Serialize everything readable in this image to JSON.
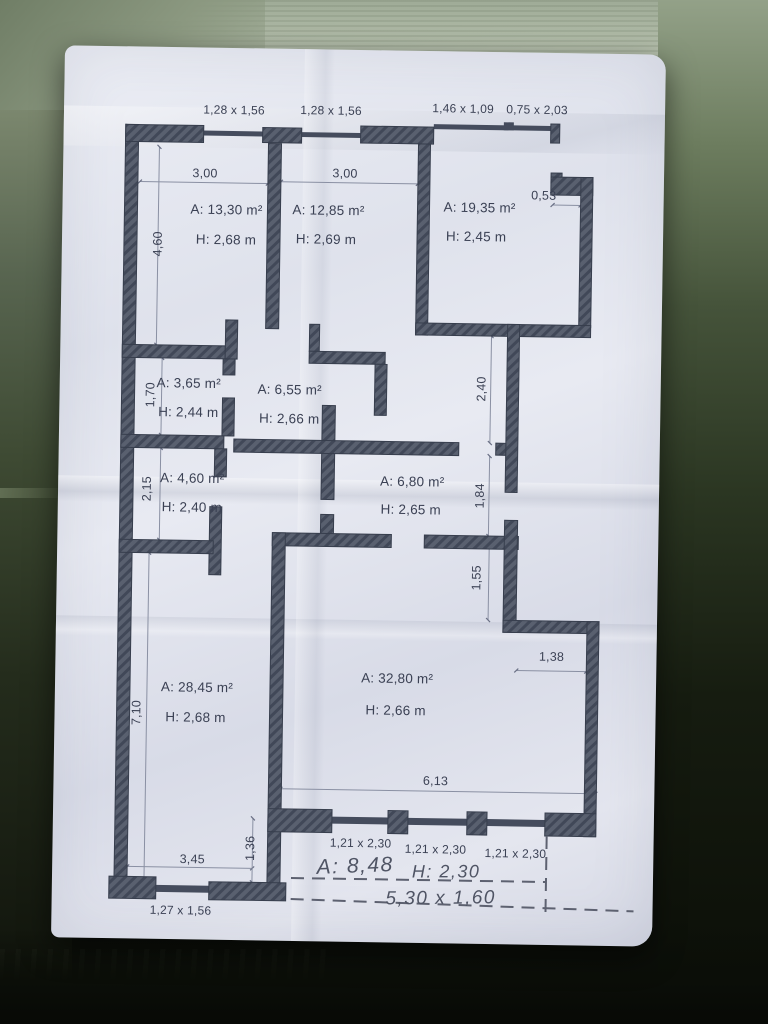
{
  "colors": {
    "wall": "#4e5565",
    "wall_hatch": "#3f4656",
    "paper": "#e2e4ed",
    "ink": "#3b4154",
    "pencil": "#565b68",
    "background_fabric_light": "#b5bfac",
    "background_fabric_dark": "#11150f"
  },
  "plan": {
    "top_openings": [
      "1,28 x 1,56",
      "1,28 x 1,56",
      "1,46 x 1,09",
      "0,75 x 2,03"
    ],
    "rooms": [
      {
        "area": "A: 13,30 m²",
        "height": "H: 2,68 m"
      },
      {
        "area": "A: 12,85 m²",
        "height": "H: 2,69 m"
      },
      {
        "area": "A: 19,35 m²",
        "height": "H: 2,45 m"
      },
      {
        "area": "A: 3,65 m²",
        "height": "H: 2,44 m"
      },
      {
        "area": "A: 6,55 m²",
        "height": "H: 2,66 m"
      },
      {
        "area": "A: 4,60 m²",
        "height": "H: 2,40 m"
      },
      {
        "area": "A: 6,80 m²",
        "height": "H: 2,65 m"
      },
      {
        "area": "A: 28,45 m²",
        "height": "H: 2,68 m"
      },
      {
        "area": "A: 32,80 m²",
        "height": "H: 2,66 m"
      }
    ],
    "dimensions": {
      "room1_width": "3,00",
      "room2_width": "3,00",
      "right_step": "0,53",
      "left_top": "4,60",
      "left_mid1": "1,70",
      "left_mid2": "2,15",
      "left_bottom": "7,10",
      "right_mid1": "2,40",
      "right_mid2": "1,84",
      "right_mid3": "1,55",
      "right_notch": "1,38",
      "bottom_width": "6,13",
      "bottom_left_width": "3,45",
      "bottom_left_step": "1,36"
    },
    "bottom_windows": [
      "1,21 x 2,30",
      "1,21 x 2,30",
      "1,21 x 2,30"
    ],
    "bottom_left_window": "1,27 x 1,56",
    "handwritten": {
      "area": "A: 8,48",
      "height": "H: 2,30",
      "balcony_size": "5,30 x 1,60"
    }
  }
}
